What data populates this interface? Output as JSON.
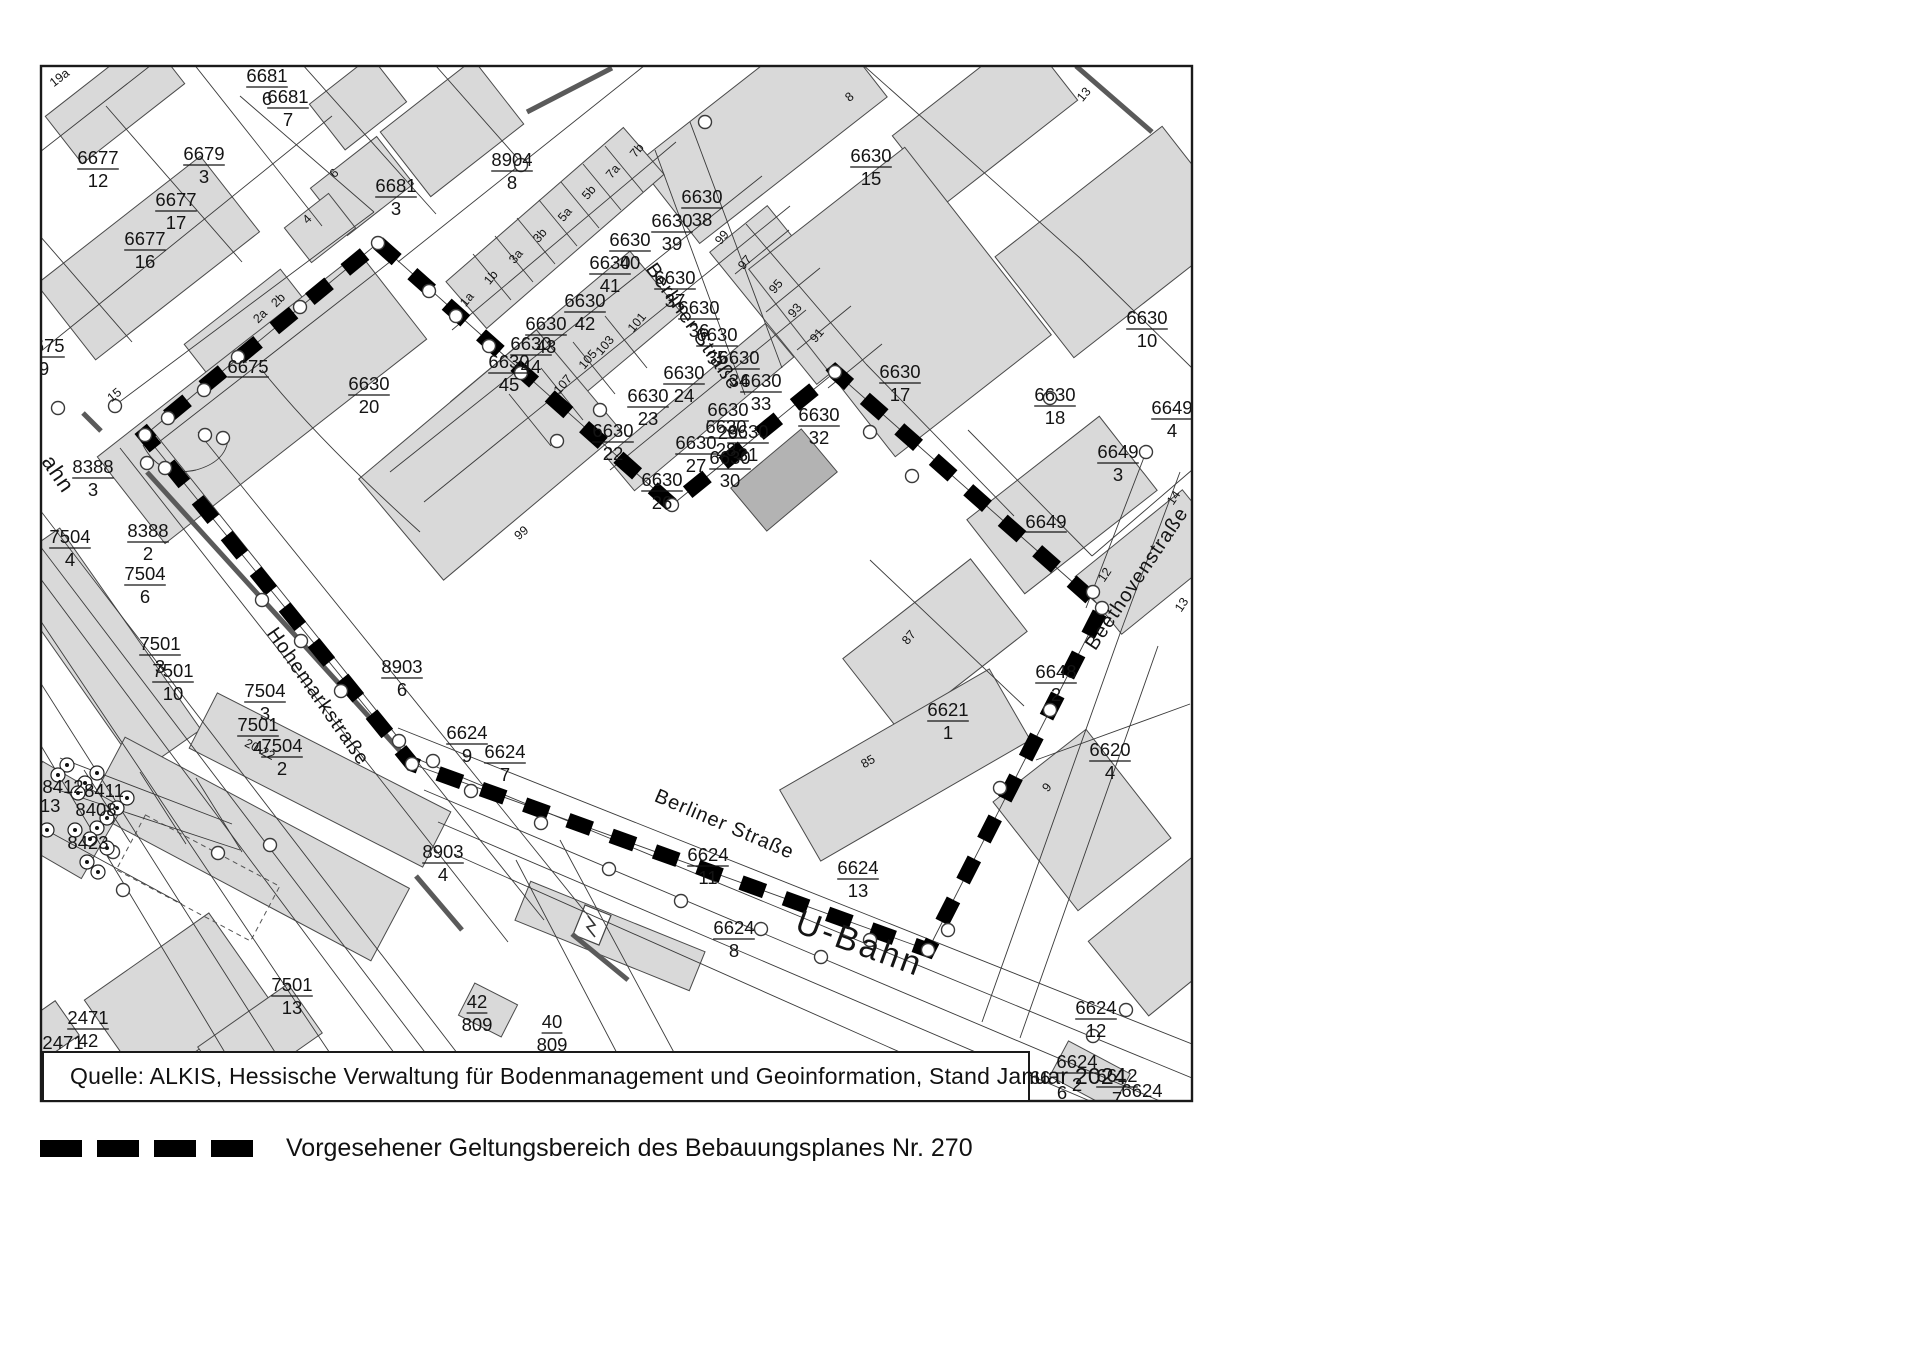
{
  "title": "Kartenausschnitt Geltungsbereich Bebauungsplan Nr. 270",
  "colors": {
    "building_fill": "#d9d9d9",
    "building_fill_dark": "#b3b3b3",
    "parcel_line": "#3a3a3a",
    "boundary": "#000000",
    "background": "#ffffff"
  },
  "source_box": {
    "text": "Quelle: ALKIS, Hessische Verwaltung für Bodenmanagement und Geoinformation, Stand Januar 2024"
  },
  "legend": {
    "label": "Vorgesehener Geltungsbereich des Bebauungsplanes Nr. 270",
    "symbol": "dashed-black-line"
  },
  "map": {
    "street_labels": [
      {
        "t": "Berliner Straße",
        "x": 688,
        "y": 330,
        "r": 55,
        "s": 20
      },
      {
        "t": "Berliner Straße",
        "x": 722,
        "y": 830,
        "r": 23,
        "s": 20
      },
      {
        "t": "Hohemarkstraße",
        "x": 313,
        "y": 700,
        "r": 55,
        "s": 20
      },
      {
        "t": "Beethovenstraße",
        "x": 1142,
        "y": 582,
        "r": -56,
        "s": 20
      },
      {
        "t": "U-Bahn",
        "x": 856,
        "y": 954,
        "r": 20,
        "s": 34
      },
      {
        "t": "ahn",
        "x": 52,
        "y": 478,
        "r": 56,
        "s": 22
      }
    ],
    "parcel_labels": [
      {
        "n": "6681",
        "d": "6",
        "x": 267,
        "y": 86
      },
      {
        "n": "6681",
        "d": "7",
        "x": 288,
        "y": 107
      },
      {
        "n": "6677",
        "d": "12",
        "x": 98,
        "y": 168
      },
      {
        "n": "6679",
        "d": "3",
        "x": 204,
        "y": 164
      },
      {
        "n": "6677",
        "d": "17",
        "x": 176,
        "y": 210
      },
      {
        "n": "6681",
        "d": "3",
        "x": 396,
        "y": 196
      },
      {
        "n": "8904",
        "d": "8",
        "x": 512,
        "y": 170
      },
      {
        "n": "6677",
        "d": "16",
        "x": 145,
        "y": 249
      },
      {
        "n": "6675",
        "d": "9",
        "x": 44,
        "y": 356
      },
      {
        "n": "8388",
        "d": "3",
        "x": 93,
        "y": 477
      },
      {
        "n": "8388",
        "d": "2",
        "x": 148,
        "y": 541
      },
      {
        "n": "7504",
        "d": "4",
        "x": 70,
        "y": 547
      },
      {
        "n": "7504",
        "d": "6",
        "x": 145,
        "y": 584
      },
      {
        "n": "7501",
        "d": "3",
        "x": 160,
        "y": 654
      },
      {
        "n": "7501",
        "d": "10",
        "x": 173,
        "y": 681
      },
      {
        "n": "7504",
        "d": "3",
        "x": 265,
        "y": 701
      },
      {
        "n": "7501",
        "d": "4",
        "x": 258,
        "y": 735
      },
      {
        "n": "7504",
        "d": "2",
        "x": 282,
        "y": 756
      },
      {
        "n": "8903",
        "d": "6",
        "x": 402,
        "y": 677
      },
      {
        "n": "6624",
        "d": "9",
        "x": 467,
        "y": 743
      },
      {
        "n": "6624",
        "d": "7",
        "x": 505,
        "y": 762
      },
      {
        "n": "8903",
        "d": "4",
        "x": 443,
        "y": 862
      },
      {
        "n": "6630",
        "d": "20",
        "x": 369,
        "y": 394
      },
      {
        "n": "6630",
        "d": "38",
        "x": 702,
        "y": 207
      },
      {
        "n": "6630",
        "d": "39",
        "x": 672,
        "y": 231
      },
      {
        "n": "6630",
        "d": "40",
        "x": 630,
        "y": 250
      },
      {
        "n": "6630",
        "d": "41",
        "x": 610,
        "y": 273
      },
      {
        "n": "6630",
        "d": "42",
        "x": 585,
        "y": 311
      },
      {
        "n": "6630",
        "d": "43",
        "x": 546,
        "y": 334
      },
      {
        "n": "6630",
        "d": "44",
        "x": 531,
        "y": 354
      },
      {
        "n": "6630",
        "d": "45",
        "x": 509,
        "y": 372
      },
      {
        "n": "6630",
        "d": "37",
        "x": 675,
        "y": 288
      },
      {
        "n": "6630",
        "d": "36",
        "x": 699,
        "y": 318
      },
      {
        "n": "6630",
        "d": "35",
        "x": 717,
        "y": 345
      },
      {
        "n": "6630",
        "d": "34",
        "x": 739,
        "y": 368
      },
      {
        "n": "6630",
        "d": "33",
        "x": 761,
        "y": 391
      },
      {
        "n": "6630",
        "d": "24",
        "x": 684,
        "y": 383
      },
      {
        "n": "6630",
        "d": "23",
        "x": 648,
        "y": 406
      },
      {
        "n": "6630",
        "d": "22",
        "x": 613,
        "y": 441
      },
      {
        "n": "6630",
        "d": "27",
        "x": 696,
        "y": 453
      },
      {
        "n": "6630",
        "d": "28",
        "x": 726,
        "y": 437
      },
      {
        "n": "6630",
        "d": "29",
        "x": 728,
        "y": 420
      },
      {
        "n": "6630",
        "d": "31",
        "x": 748,
        "y": 442
      },
      {
        "n": "6630",
        "d": "30",
        "x": 730,
        "y": 468
      },
      {
        "n": "6630",
        "d": "26",
        "x": 662,
        "y": 490
      },
      {
        "n": "6630",
        "d": "32",
        "x": 819,
        "y": 425
      },
      {
        "n": "6630",
        "d": "15",
        "x": 871,
        "y": 166
      },
      {
        "n": "6630",
        "d": "17",
        "x": 900,
        "y": 382
      },
      {
        "n": "6630",
        "d": "18",
        "x": 1055,
        "y": 405
      },
      {
        "n": "6630",
        "d": "10",
        "x": 1147,
        "y": 328
      },
      {
        "n": "6649",
        "d": "4",
        "x": 1172,
        "y": 418
      },
      {
        "n": "6649",
        "d": "3",
        "x": 1118,
        "y": 462
      },
      {
        "n": "6648",
        "d": "2",
        "x": 1056,
        "y": 682
      },
      {
        "n": "6621",
        "d": "1",
        "x": 948,
        "y": 720
      },
      {
        "n": "6620",
        "d": "4",
        "x": 1110,
        "y": 760
      },
      {
        "n": "6624",
        "d": "11",
        "x": 708,
        "y": 865
      },
      {
        "n": "6624",
        "d": "13",
        "x": 858,
        "y": 878
      },
      {
        "n": "6624",
        "d": "8",
        "x": 734,
        "y": 938
      },
      {
        "n": "42",
        "d": "809",
        "x": 477,
        "y": 1012
      },
      {
        "n": "40",
        "d": "809",
        "x": 552,
        "y": 1032
      },
      {
        "n": "7501",
        "d": "13",
        "x": 292,
        "y": 995
      },
      {
        "n": "2471",
        "d": "42",
        "x": 88,
        "y": 1028
      },
      {
        "n": "6624",
        "d": "12",
        "x": 1096,
        "y": 1018
      },
      {
        "n": "6624",
        "d": "2",
        "x": 1077,
        "y": 1072
      },
      {
        "n": "6612",
        "d": "7",
        "x": 1117,
        "y": 1086
      }
    ],
    "single_labels": [
      {
        "t": "6675",
        "x": 248,
        "y": 373,
        "u": true
      },
      {
        "t": "6649",
        "x": 1046,
        "y": 528,
        "u": true
      },
      {
        "t": "8412",
        "x": 63,
        "y": 793,
        "u": false
      },
      {
        "t": "8411",
        "x": 104,
        "y": 797,
        "u": false
      },
      {
        "t": "413",
        "x": 45,
        "y": 812,
        "u": false
      },
      {
        "t": "8408",
        "x": 96,
        "y": 816,
        "u": false
      },
      {
        "t": "8423",
        "x": 88,
        "y": 849,
        "u": false
      },
      {
        "t": "2471",
        "x": 63,
        "y": 1049,
        "u": true
      },
      {
        "t": "66",
        "x": 1040,
        "y": 1084,
        "u": false
      },
      {
        "t": "6",
        "x": 1062,
        "y": 1099,
        "u": false
      },
      {
        "t": "6624",
        "x": 1142,
        "y": 1097,
        "u": true
      }
    ],
    "house_numbers": [
      {
        "t": "19a",
        "x": 62,
        "y": 81,
        "r": -38
      },
      {
        "t": "8",
        "x": 373,
        "y": 66,
        "r": 0
      },
      {
        "t": "8",
        "x": 852,
        "y": 100,
        "r": -40
      },
      {
        "t": "13",
        "x": 1087,
        "y": 97,
        "r": -50
      },
      {
        "t": "6",
        "x": 337,
        "y": 176,
        "r": -45
      },
      {
        "t": "4",
        "x": 310,
        "y": 222,
        "r": -45
      },
      {
        "t": "2b",
        "x": 281,
        "y": 303,
        "r": -45
      },
      {
        "t": "2a",
        "x": 263,
        "y": 319,
        "r": -45
      },
      {
        "t": "15",
        "x": 117,
        "y": 398,
        "r": -40
      },
      {
        "t": "1a",
        "x": 470,
        "y": 302,
        "r": -50
      },
      {
        "t": "1b",
        "x": 494,
        "y": 280,
        "r": -50
      },
      {
        "t": "3a",
        "x": 519,
        "y": 259,
        "r": -50
      },
      {
        "t": "3b",
        "x": 543,
        "y": 238,
        "r": -50
      },
      {
        "t": "5a",
        "x": 568,
        "y": 217,
        "r": -50
      },
      {
        "t": "5b",
        "x": 592,
        "y": 195,
        "r": -50
      },
      {
        "t": "7a",
        "x": 616,
        "y": 174,
        "r": -50
      },
      {
        "t": "7b",
        "x": 640,
        "y": 153,
        "r": -50
      },
      {
        "t": "107",
        "x": 566,
        "y": 387,
        "r": -50
      },
      {
        "t": "105",
        "x": 591,
        "y": 362,
        "r": -50
      },
      {
        "t": "103",
        "x": 608,
        "y": 348,
        "r": -50
      },
      {
        "t": "101",
        "x": 640,
        "y": 325,
        "r": -50
      },
      {
        "t": "99",
        "x": 725,
        "y": 240,
        "r": -50
      },
      {
        "t": "97",
        "x": 748,
        "y": 265,
        "r": -50
      },
      {
        "t": "95",
        "x": 779,
        "y": 289,
        "r": -50
      },
      {
        "t": "93",
        "x": 798,
        "y": 313,
        "r": -50
      },
      {
        "t": "91",
        "x": 820,
        "y": 338,
        "r": -50
      },
      {
        "t": "99",
        "x": 524,
        "y": 536,
        "r": -40
      },
      {
        "t": "12",
        "x": 1108,
        "y": 577,
        "r": -56
      },
      {
        "t": "13",
        "x": 1185,
        "y": 607,
        "r": -56
      },
      {
        "t": "14",
        "x": 1177,
        "y": 500,
        "r": -56
      },
      {
        "t": "9",
        "x": 1050,
        "y": 790,
        "r": -50
      },
      {
        "t": "87",
        "x": 912,
        "y": 640,
        "r": -50
      },
      {
        "t": "85",
        "x": 870,
        "y": 765,
        "r": -30
      },
      {
        "t": "20-22",
        "x": 258,
        "y": 753,
        "r": 27
      }
    ]
  }
}
